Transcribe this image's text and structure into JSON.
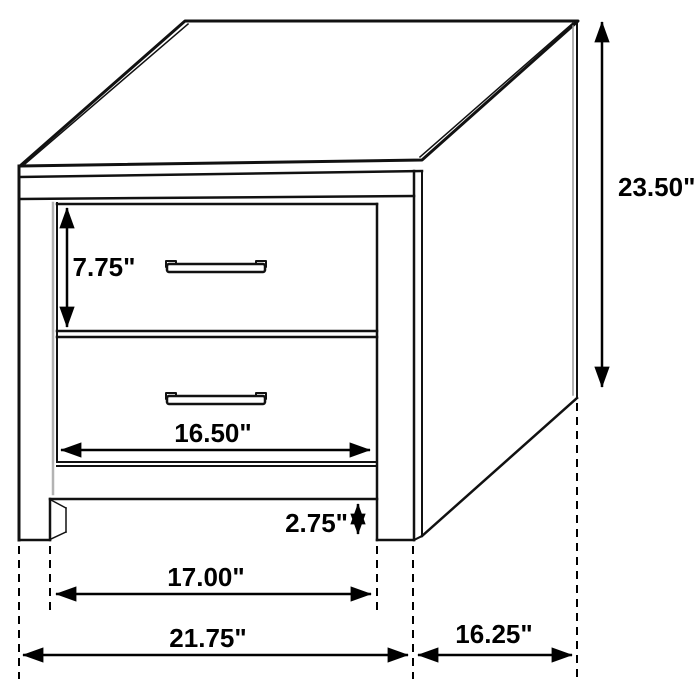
{
  "diagram": {
    "type": "furniture-dimension-diagram",
    "subject": "two-drawer nightstand line drawing with dimension arrows",
    "unit": "inches",
    "background_color": "#ffffff",
    "line_color": "#000000",
    "dimensions": {
      "overall_height": "23.50\"",
      "drawer_front_height": "7.75\"",
      "drawer_front_width": "16.50\"",
      "base_clearance_height": "2.75\"",
      "between_legs_width": "17.00\"",
      "overall_width": "21.75\"",
      "side_depth": "16.25\""
    }
  }
}
